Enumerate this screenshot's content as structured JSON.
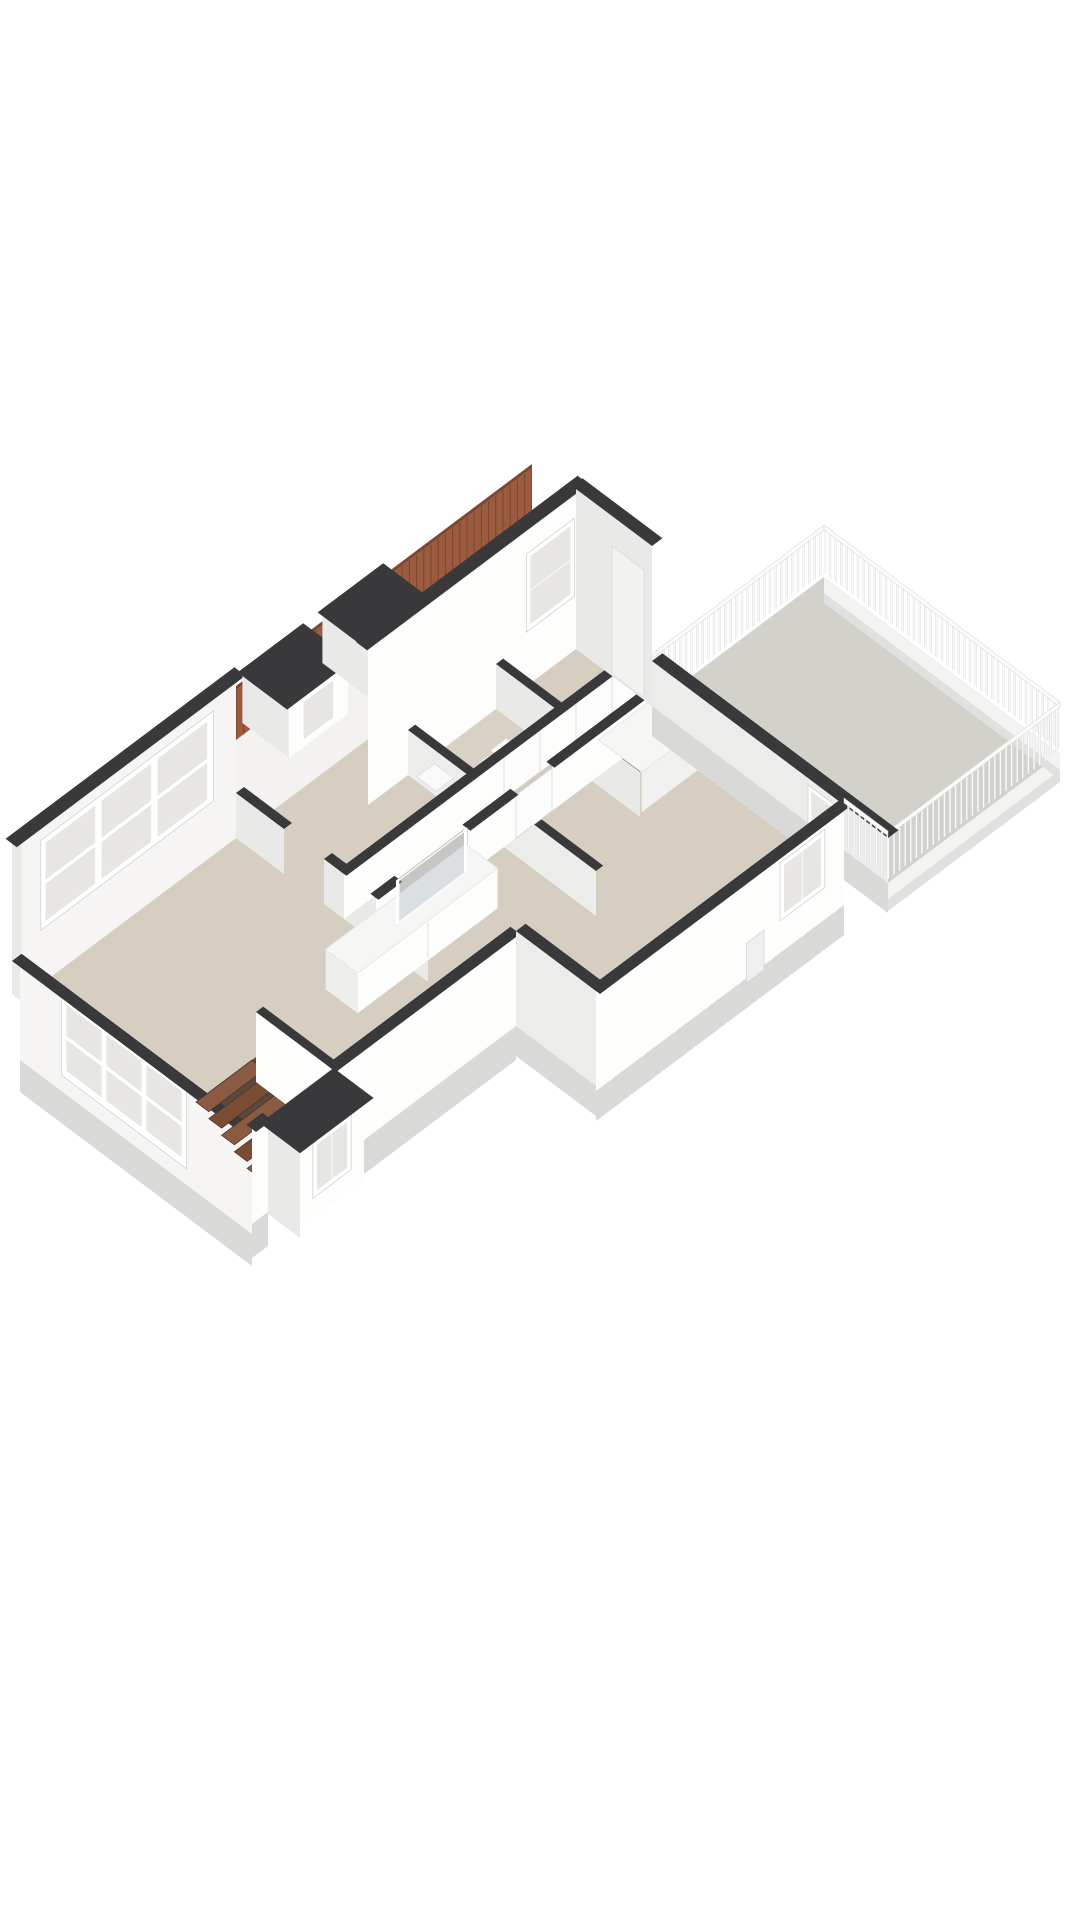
{
  "scene": {
    "kind": "3d-floorplan-render",
    "view": "isometric-top",
    "features": [
      "roof-terrace-with-railing",
      "living-room",
      "hallway",
      "toilet-room",
      "bedrooms",
      "staircase",
      "kitchen-counter",
      "glass-partition",
      "dormer-windows",
      "roof-tiles"
    ]
  },
  "colors": {
    "background": "#ffffff",
    "wall_top": "#39393b",
    "wall_top_soft": "#454547",
    "wall_white": "#fdfdfc",
    "wall_interior": "#f6f5f4",
    "wall_shade": "#e9e9e8",
    "wall_shade2": "#ececeb",
    "wall_knee": "#f3f2f0",
    "facade_lower": "#d9d9d8",
    "floor_main": "#d5cec1",
    "floor_hall": "#d1cbbe",
    "floor_toilet": "#d8d2c6",
    "floor_void": "#5a4a3e",
    "terrace_floor": "#d2d1ca",
    "terrace_fascia": "#f3f3f2",
    "terrace_fascia_shadow": "#e0e0df",
    "tiles": "#9a5b3e",
    "tiles_shade": "#7e4630",
    "stair_light": "#8b5b41",
    "stair_dark": "#7a4c34",
    "glass_window": "#e7e6e2",
    "glass_partition": "rgba(185,196,202,0.45)",
    "counter_top": "#f6f6f5",
    "counter_face": "#fdfdfc",
    "counter_end": "#ededec",
    "closet_face": "#f1f1f0",
    "terrace_door": "#f2f2f1"
  }
}
